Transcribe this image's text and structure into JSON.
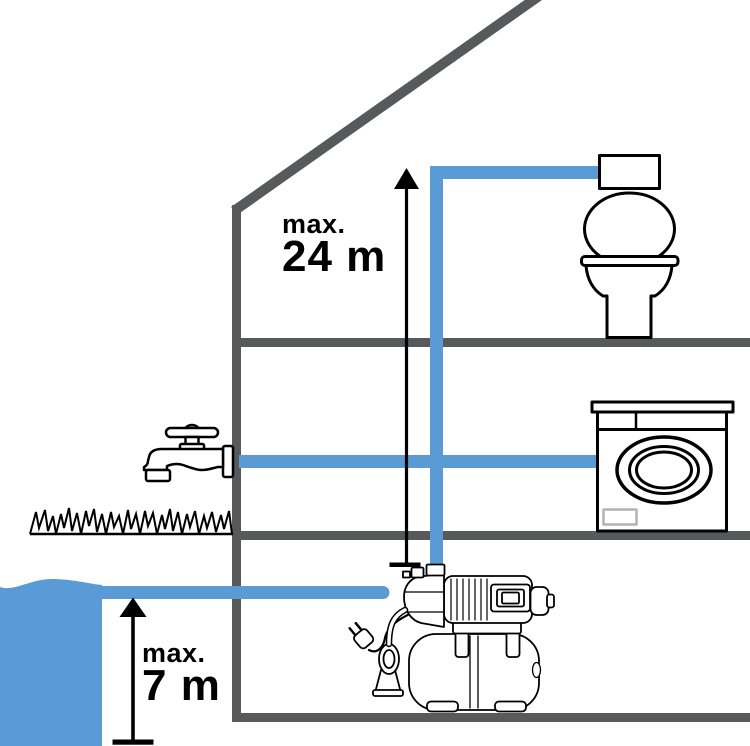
{
  "colors": {
    "water": "#5b9bd5",
    "structure": "#58595b",
    "outline": "#000000",
    "panel_gray": "#b3b3b3"
  },
  "labels": {
    "delivery_height": {
      "prefix": "max.",
      "value": "24 m"
    },
    "suction_height": {
      "prefix": "max.",
      "value": "7 m"
    }
  }
}
